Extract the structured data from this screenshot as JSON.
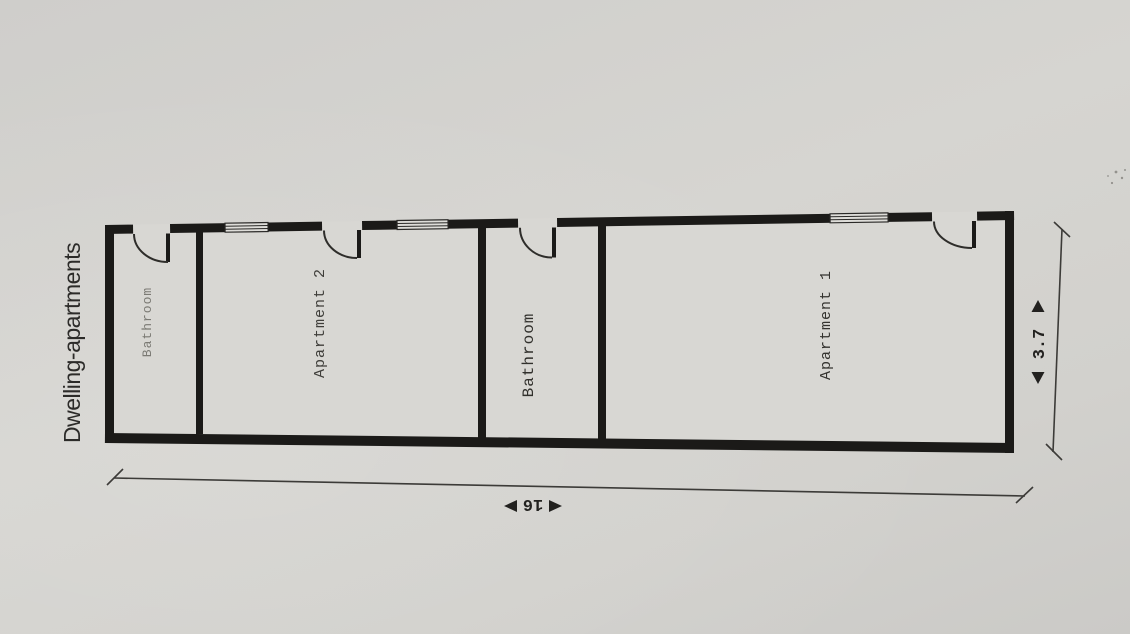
{
  "page": {
    "title": "Dwelling-apartments"
  },
  "floor_plan": {
    "rooms": [
      {
        "label": "Bathroom"
      },
      {
        "label": "Apartment 2"
      },
      {
        "label": "Bathroom"
      },
      {
        "label": "Apartment 1"
      }
    ],
    "dimensions": {
      "length": "16",
      "depth": "3.7"
    },
    "colors": {
      "wall": "#1b1a18",
      "paper": "#d2d1ce",
      "ink": "#34332f"
    }
  }
}
